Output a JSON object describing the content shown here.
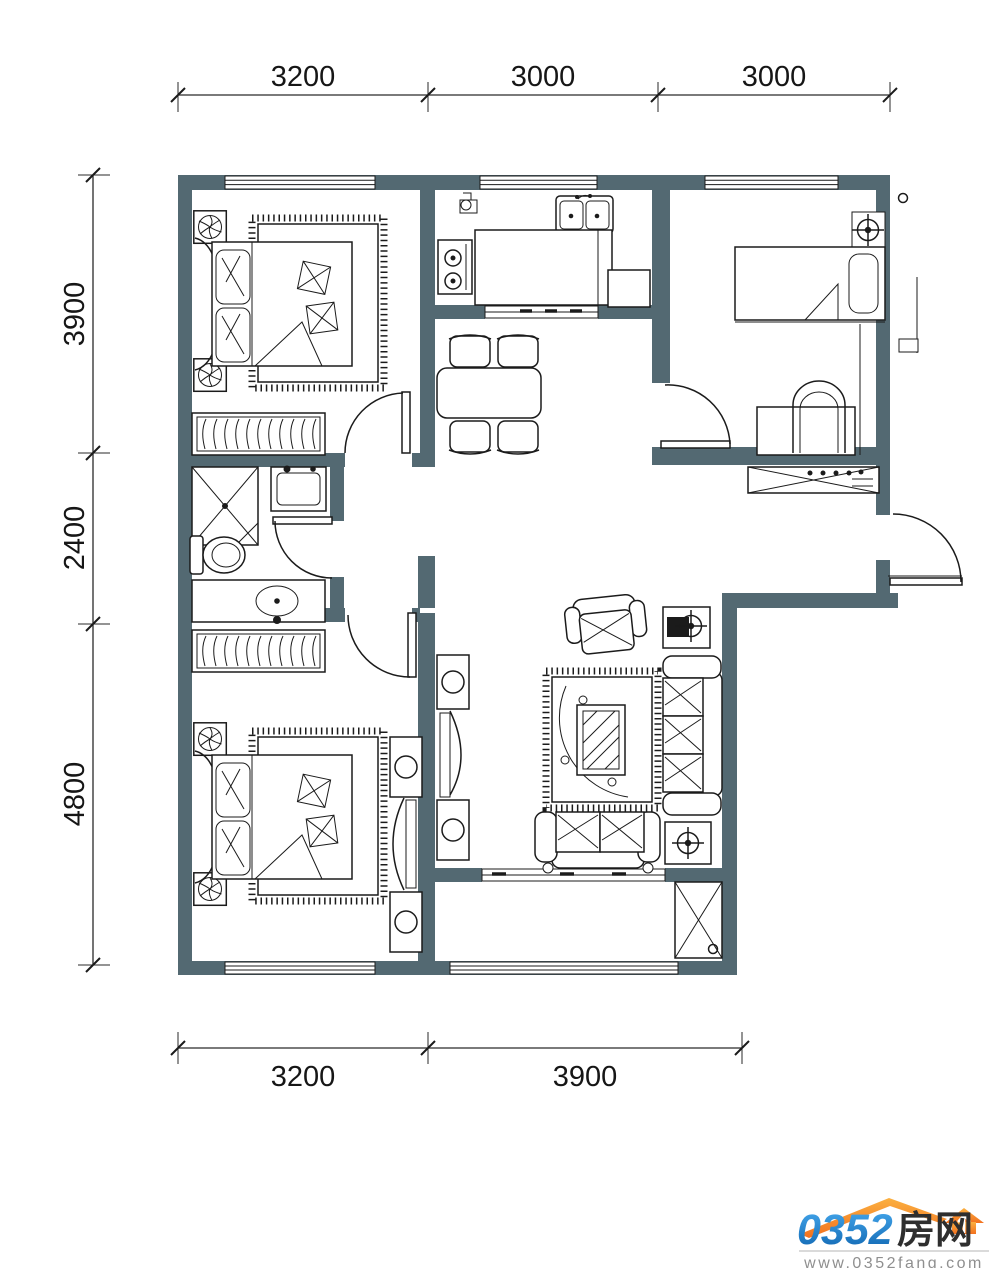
{
  "dimensions": {
    "top": [
      "3200",
      "3000",
      "3000"
    ],
    "left": [
      "3900",
      "2400",
      "4800"
    ],
    "bottom": [
      "3200",
      "3900"
    ]
  },
  "logo": {
    "brand_number": "0352",
    "brand_suffix": "房网",
    "website": "www.0352fang.com"
  },
  "icons": [
    "ceiling-fan-icon",
    "crosshair-lamp-icon",
    "roof-logo-icon"
  ],
  "colors": {
    "wall": "#536972",
    "line": "#1b1b1b",
    "logo_blue_top": "#47aaef",
    "logo_blue_bottom": "#0d63ae",
    "logo_orange": "#f7941d",
    "logo_gray": "#8f8f8f"
  }
}
